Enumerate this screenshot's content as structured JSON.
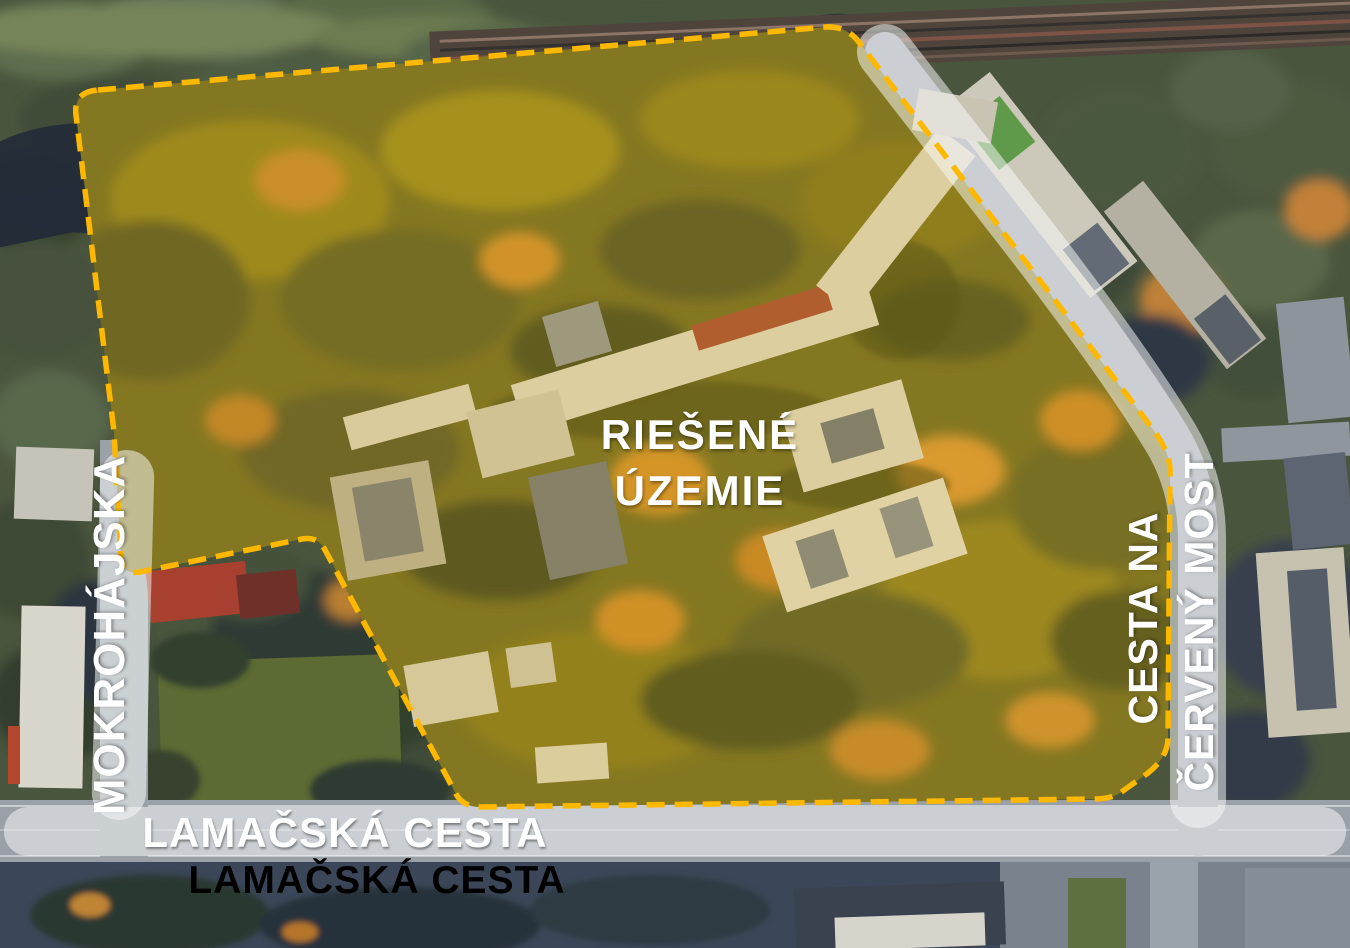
{
  "map": {
    "area_label_line1": "RIEŠENÉ",
    "area_label_line2": "ÚZEMIE",
    "roads": {
      "left": "MOKROHÁJSKA",
      "right_line1": "CESTA NA",
      "right_line2": "ČERVENÝ MOST",
      "bottom_on_road": "LAMAČSKÁ CESTA",
      "bottom_below_road": "LAMAČSKÁ CESTA"
    },
    "boundary": {
      "color": "#FFB800",
      "style": "dashed"
    },
    "highlight_fill": "rgba(255,198,0,0.16)",
    "band_fill": "rgba(250,251,252,0.52)"
  }
}
